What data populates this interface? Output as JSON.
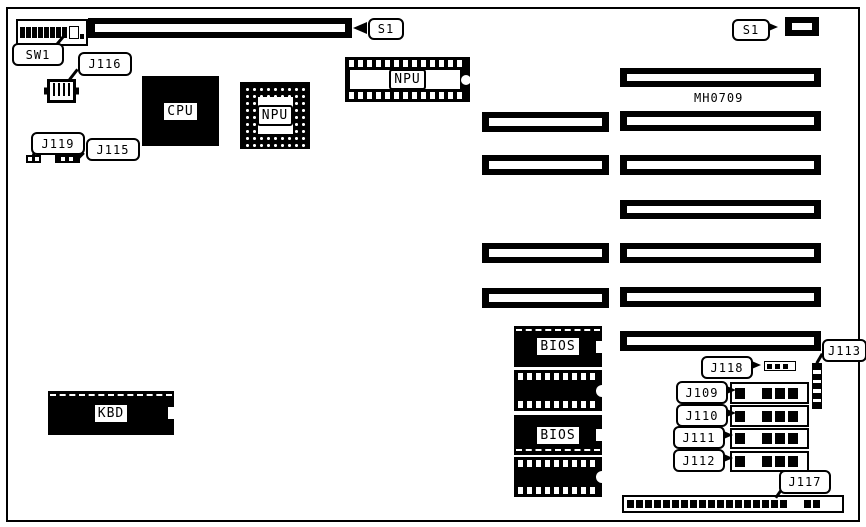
{
  "board": {
    "id_text": "MH0709",
    "background_color": "#ffffff",
    "line_color": "#000000"
  },
  "callouts": {
    "sw1": "SW1",
    "j116": "J116",
    "j119": "J119",
    "j115": "J115",
    "s1_top": "S1",
    "s1_right": "S1",
    "j113": "J113",
    "j118": "J118",
    "j109": "J109",
    "j110": "J110",
    "j111": "J111",
    "j112": "J112",
    "j117": "J117"
  },
  "chips": {
    "cpu": "CPU",
    "npu_dip": "NPU",
    "npu_pga": "NPU",
    "bios_top": "BIOS",
    "bios_bottom": "BIOS",
    "kbd": "KBD"
  }
}
